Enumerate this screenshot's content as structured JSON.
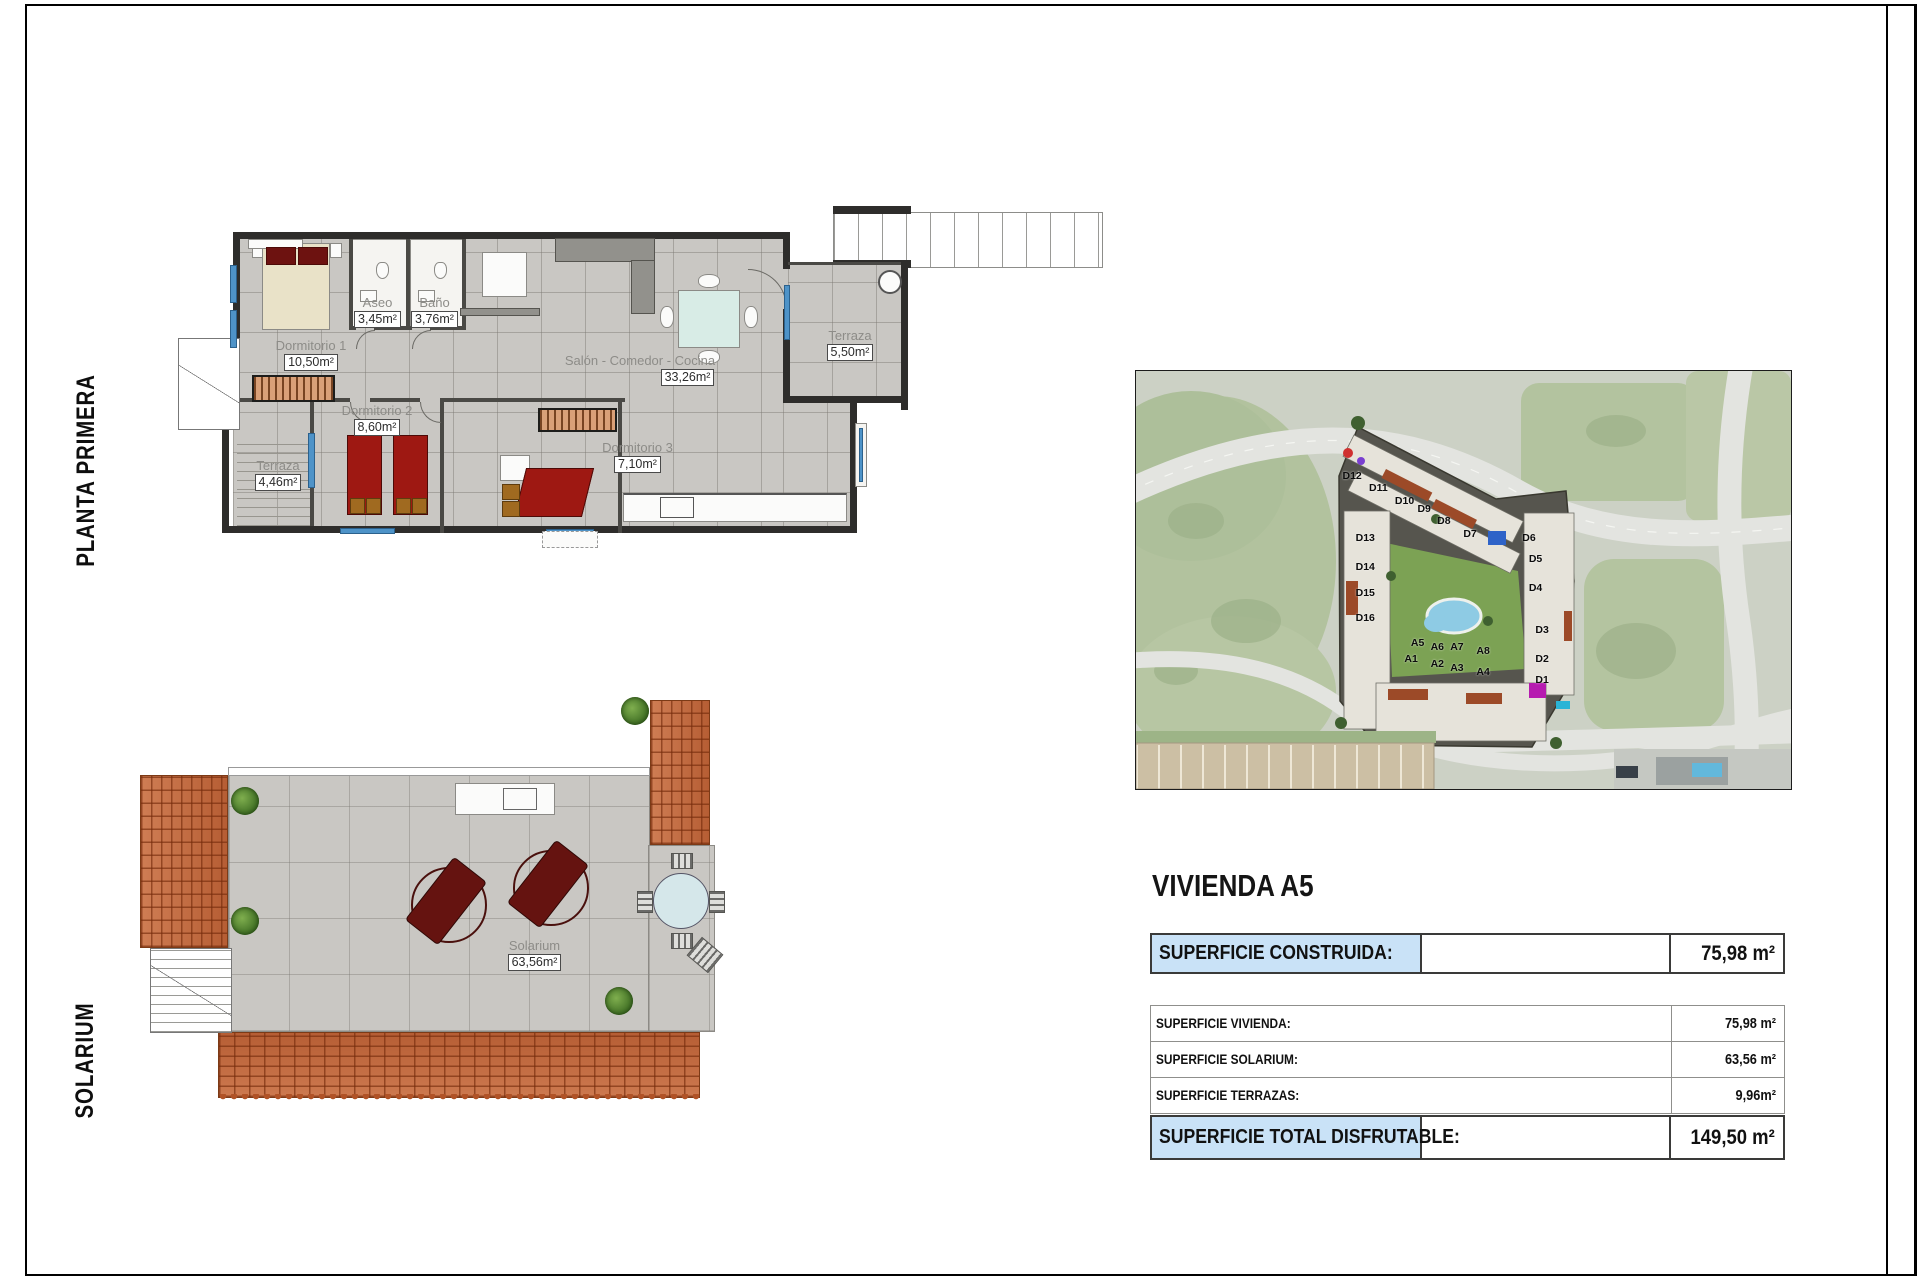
{
  "colors": {
    "highlight_blue": "#c9e2f7",
    "window_blue": "#4e93c8",
    "roof_tile": "#c4663a",
    "bed_red": "#9e1812",
    "floor_tile": "#c9c7c3",
    "courtyard_green": "#7ca254",
    "pool_blue": "#8ecbe4"
  },
  "left_margin": {
    "planta_label": "PLANTA PRIMERA",
    "solarium_label": "SOLARIUM"
  },
  "planta_primera": {
    "rooms": {
      "dormitorio1": {
        "name": "Dormitorio 1",
        "area": "10,50m²"
      },
      "aseo": {
        "name": "Aseo",
        "area": "3,45m²"
      },
      "bano": {
        "name": "Baño",
        "area": "3,76m²"
      },
      "salon": {
        "name": "Salón - Comedor - Cocina",
        "area": "33,26m²"
      },
      "dormitorio2": {
        "name": "Dormitorio 2",
        "area": "8,60m²"
      },
      "dormitorio3": {
        "name": "Dormitorio 3",
        "area": "7,10m²"
      },
      "terraza_derecha": {
        "name": "Terraza",
        "area": "5,50m²"
      },
      "terraza_izquierda": {
        "name": "Terraza",
        "area": "4,46m²"
      }
    }
  },
  "solarium": {
    "room": {
      "name": "Solarium",
      "area": "63,56m²"
    }
  },
  "site_map": {
    "unit_labels": [
      {
        "text": "D12",
        "x": 33,
        "y": 25
      },
      {
        "text": "D11",
        "x": 37,
        "y": 28
      },
      {
        "text": "D10",
        "x": 41,
        "y": 31
      },
      {
        "text": "D9",
        "x": 44,
        "y": 33
      },
      {
        "text": "D8",
        "x": 47,
        "y": 36
      },
      {
        "text": "D7",
        "x": 51,
        "y": 39
      },
      {
        "text": "D13",
        "x": 35,
        "y": 40
      },
      {
        "text": "D14",
        "x": 35,
        "y": 47
      },
      {
        "text": "D15",
        "x": 35,
        "y": 53
      },
      {
        "text": "D16",
        "x": 35,
        "y": 59
      },
      {
        "text": "D6",
        "x": 60,
        "y": 40
      },
      {
        "text": "D5",
        "x": 61,
        "y": 45
      },
      {
        "text": "D4",
        "x": 61,
        "y": 52
      },
      {
        "text": "D3",
        "x": 62,
        "y": 62
      },
      {
        "text": "D2",
        "x": 62,
        "y": 69
      },
      {
        "text": "D1",
        "x": 62,
        "y": 74
      },
      {
        "text": "A5",
        "x": 43,
        "y": 65
      },
      {
        "text": "A6",
        "x": 46,
        "y": 66
      },
      {
        "text": "A7",
        "x": 49,
        "y": 66
      },
      {
        "text": "A8",
        "x": 53,
        "y": 67
      },
      {
        "text": "A1",
        "x": 42,
        "y": 69
      },
      {
        "text": "A2",
        "x": 46,
        "y": 70
      },
      {
        "text": "A3",
        "x": 49,
        "y": 71
      },
      {
        "text": "A4",
        "x": 53,
        "y": 72
      }
    ]
  },
  "panel": {
    "title": "VIVIENDA A5",
    "rows": [
      {
        "label": "SUPERFICIE CONSTRUIDA:",
        "value": "75,98 m²",
        "style": "highlight"
      },
      {
        "label": "SUPERFICIE VIVIENDA:",
        "value": "75,98 m²",
        "style": "plain"
      },
      {
        "label": "SUPERFICIE SOLARIUM:",
        "value": "63,56 m²",
        "style": "plain"
      },
      {
        "label": "SUPERFICIE TERRAZAS:",
        "value": "9,96m²",
        "style": "plain"
      },
      {
        "label": "SUPERFICIE TOTAL DISFRUTABLE:",
        "value": "149,50 m²",
        "style": "highlight"
      }
    ]
  }
}
